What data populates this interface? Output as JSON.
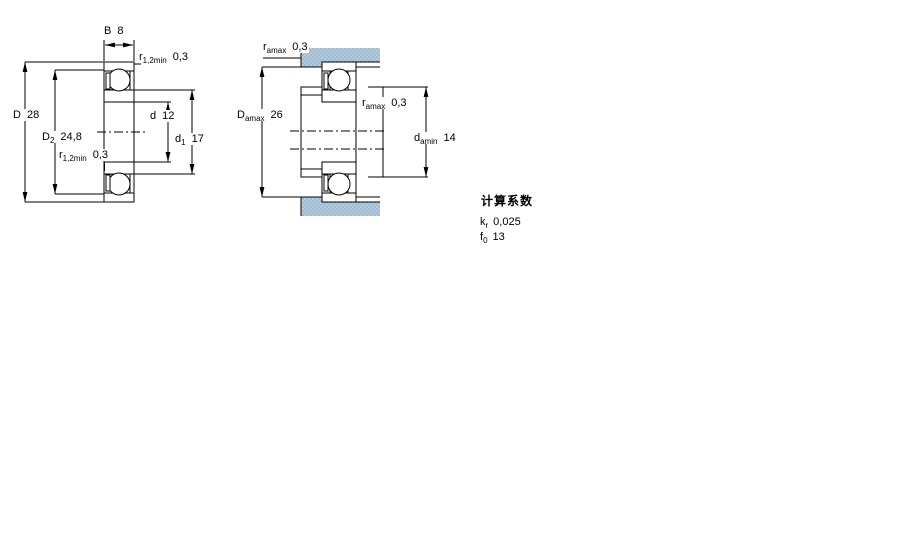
{
  "drawing": {
    "left_view": {
      "dims": {
        "B": {
          "base": "B",
          "sub": "",
          "value": "8"
        },
        "r12_top": {
          "base": "r",
          "sub": "1,2min",
          "value": "0,3"
        },
        "D": {
          "base": "D",
          "sub": "",
          "value": "28"
        },
        "D2": {
          "base": "D",
          "sub": "2",
          "value": "24,8"
        },
        "r12_bottom": {
          "base": "r",
          "sub": "1,2min",
          "value": "0,3"
        },
        "d": {
          "base": "d",
          "sub": "",
          "value": "12"
        },
        "d1": {
          "base": "d",
          "sub": "1",
          "value": "17"
        }
      }
    },
    "right_view": {
      "dims": {
        "ra_top": {
          "base": "r",
          "sub": "amax",
          "value": "0,3"
        },
        "Da_max": {
          "base": "D",
          "sub": "amax",
          "value": "26"
        },
        "ra_mid": {
          "base": "r",
          "sub": "amax",
          "value": "0,3"
        },
        "da_min": {
          "base": "d",
          "sub": "amin",
          "value": "14"
        }
      }
    },
    "calculation_factors": {
      "title": "计算系数",
      "rows": [
        {
          "base": "k",
          "sub": "r",
          "value": "0,025"
        },
        {
          "base": "f",
          "sub": "0",
          "value": "13"
        }
      ]
    },
    "colors": {
      "section_fill": "#b3cbdd",
      "section_dot": "#7ea6c0",
      "line": "#000000",
      "background": "#ffffff"
    }
  }
}
